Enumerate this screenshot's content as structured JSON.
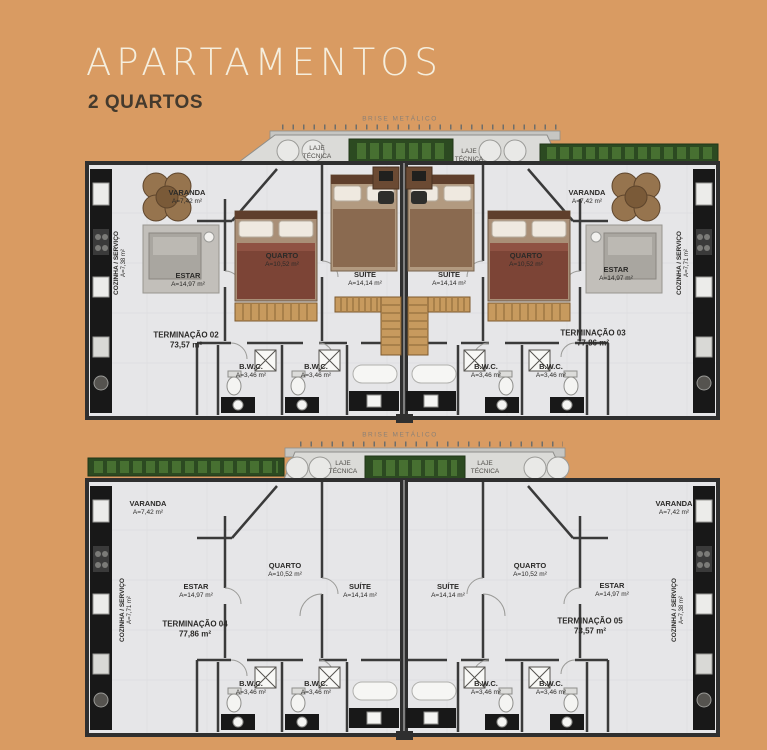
{
  "header": {
    "title": "APARTAMENTOS",
    "subtitle": "2 QUARTOS"
  },
  "colors": {
    "background": "#d99b62",
    "title_text": "#f5eedd",
    "subtitle_text": "#443a2d",
    "floor": "#e6e6e8",
    "wall": "#2f2f2f",
    "hedge_green": "#2c4a21",
    "wood_tan": "#c79a5e",
    "bed_brown": "#7c4436",
    "counter_black": "#181818"
  },
  "plan_top": {
    "brise": "BRISE METÁLICO",
    "laje_left": "LAJE\nTÉCNICA",
    "laje_right": "LAJE\nTÉCNICA",
    "unit_left": {
      "name": "TERMINAÇÃO 02",
      "area": "73,57 m²",
      "varanda": "VARANDA",
      "varanda_area": "A=7,42 m²",
      "estar": "ESTAR",
      "estar_area": "A=14,97 m²",
      "quarto": "QUARTO",
      "quarto_area": "A=10,52 m²",
      "suite": "SUÍTE",
      "suite_area": "A=14,14 m²",
      "bwc1": "B.W.C.",
      "bwc1_area": "A=3,46 m²",
      "bwc2": "B.W.C.",
      "bwc2_area": "A=3,46 m²",
      "cozinha": "COZINHA / SERVIÇO",
      "cozinha_area": "A=7,38 m²"
    },
    "unit_right": {
      "name": "TERMINAÇÃO 03",
      "area": "77,86 m²",
      "varanda": "VARANDA",
      "varanda_area": "A=7,42 m²",
      "estar": "ESTAR",
      "estar_area": "A=14,97 m²",
      "quarto": "QUARTO",
      "quarto_area": "A=10,52 m²",
      "suite": "SUÍTE",
      "suite_area": "A=14,14 m²",
      "bwc1": "B.W.C.",
      "bwc1_area": "A=3,46 m²",
      "bwc2": "B.W.C.",
      "bwc2_area": "A=3,46 m²",
      "cozinha": "COZINHA / SERVIÇO",
      "cozinha_area": "A=7,71 m²"
    }
  },
  "plan_bottom": {
    "brise": "BRISE METÁLICO",
    "laje_left": "LAJE\nTÉCNICA",
    "laje_right": "LAJE\nTÉCNICA",
    "unit_left": {
      "name": "TERMINAÇÃO 04",
      "area": "77,86 m²",
      "varanda": "VARANDA",
      "varanda_area": "A=7,42 m²",
      "estar": "ESTAR",
      "estar_area": "A=14,97 m²",
      "quarto": "QUARTO",
      "quarto_area": "A=10,52 m²",
      "suite": "SUÍTE",
      "suite_area": "A=14,14 m²",
      "bwc1": "B.W.C.",
      "bwc1_area": "A=3,46 m²",
      "bwc2": "B.W.C.",
      "bwc2_area": "A=3,46 m²",
      "cozinha": "COZINHA / SERVIÇO",
      "cozinha_area": "A=7,71 m²"
    },
    "unit_right": {
      "name": "TERMINAÇÃO 05",
      "area": "73,57 m²",
      "varanda": "VARANDA",
      "varanda_area": "A=7,42 m²",
      "estar": "ESTAR",
      "estar_area": "A=14,97 m²",
      "quarto": "QUARTO",
      "quarto_area": "A=10,52 m²",
      "suite": "SUÍTE",
      "suite_area": "A=14,14 m²",
      "bwc1": "B.W.C.",
      "bwc1_area": "A=3,46 m²",
      "bwc2": "B.W.C.",
      "bwc2_area": "A=3,46 m²",
      "cozinha": "COZINHA / SERVIÇO",
      "cozinha_area": "A=7,38 m²"
    }
  }
}
